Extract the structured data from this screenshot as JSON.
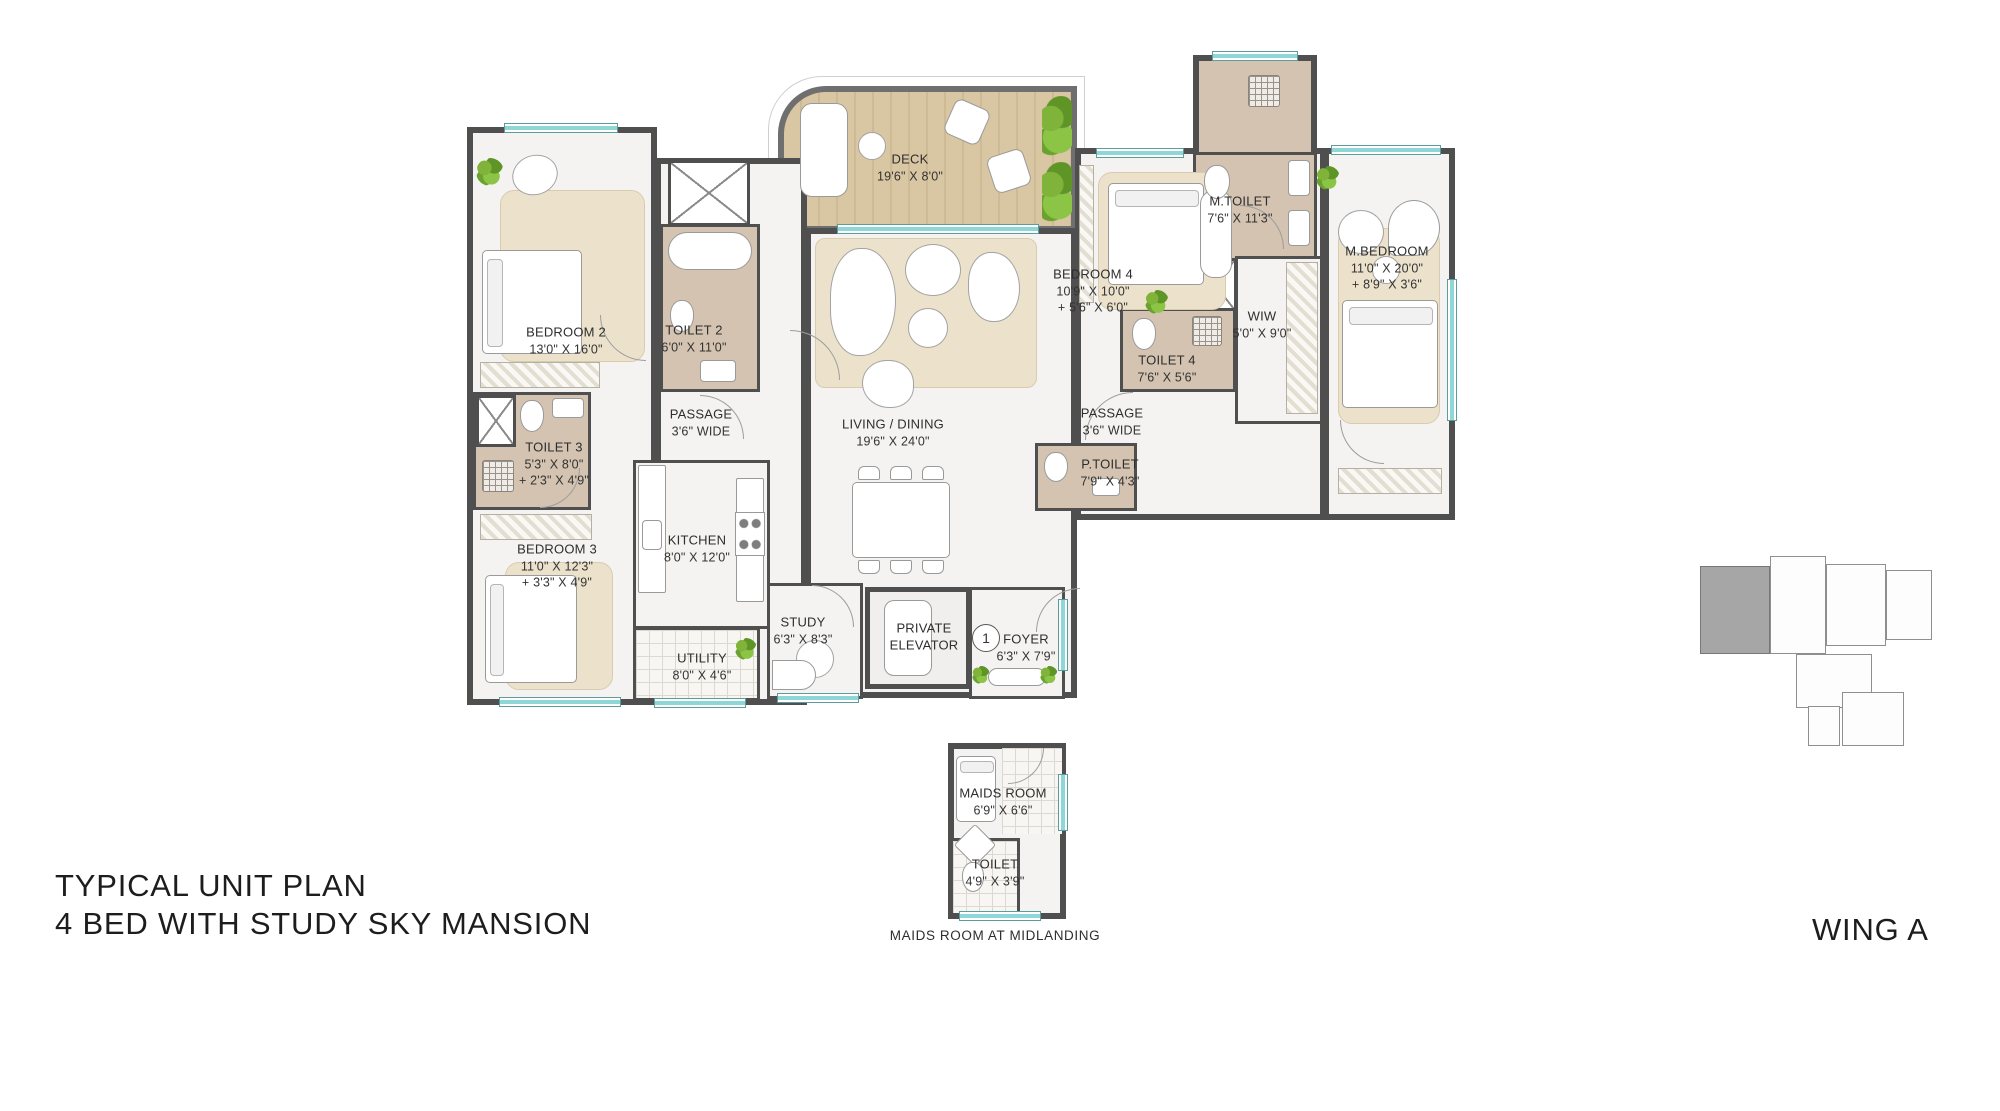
{
  "title": {
    "line1": "TYPICAL UNIT PLAN",
    "line2": "4 BED WITH STUDY SKY MANSION"
  },
  "wing": "WING A",
  "footnote": "MAIDS ROOM AT MIDLANDING",
  "foyer_marker": "1",
  "rooms": {
    "deck": {
      "name": "DECK",
      "dims": "19'6\" X 8'0\""
    },
    "bedroom2": {
      "name": "BEDROOM 2",
      "dims": "13'0\" X 16'0\""
    },
    "toilet2": {
      "name": "TOILET 2",
      "dims": "6'0\" X 11'0\""
    },
    "passage_left": {
      "name": "PASSAGE",
      "dims": "3'6\" WIDE"
    },
    "living": {
      "name": "LIVING / DINING",
      "dims": "19'6\" X 24'0\""
    },
    "bedroom4": {
      "name": "BEDROOM 4",
      "dims": "10'9\" X 10'0\"",
      "dims2": "+ 5'6\" X 6'0\""
    },
    "m_toilet": {
      "name": "M.TOILET",
      "dims": "7'6\" X 11'3\""
    },
    "wiw": {
      "name": "WIW",
      "dims": "5'0\" X 9'0\""
    },
    "toilet4": {
      "name": "TOILET 4",
      "dims": "7'6\" X 5'6\""
    },
    "passage_right": {
      "name": "PASSAGE",
      "dims": "3'6\" WIDE"
    },
    "m_bedroom": {
      "name": "M.BEDROOM",
      "dims": "11'0\" X 20'0\"",
      "dims2": "+ 8'9\" X 3'6\""
    },
    "toilet3": {
      "name": "TOILET 3",
      "dims": "5'3\" X 8'0\"",
      "dims2": "+ 2'3\" X 4'9\""
    },
    "p_toilet": {
      "name": "P.TOILET",
      "dims": "7'9\" X 4'3\""
    },
    "bedroom3": {
      "name": "BEDROOM 3",
      "dims": "11'0\" X 12'3\"",
      "dims2": "+ 3'3\" X 4'9\""
    },
    "kitchen": {
      "name": "KITCHEN",
      "dims": "8'0\" X 12'0\""
    },
    "utility": {
      "name": "UTILITY",
      "dims": "8'0\" X 4'6\""
    },
    "study": {
      "name": "STUDY",
      "dims": "6'3\" X 8'3\""
    },
    "private_elevator": {
      "name": "PRIVATE ELEVATOR"
    },
    "foyer": {
      "name": "FOYER",
      "dims": "6'3\" X 7'9\""
    },
    "maids_room": {
      "name": "MAIDS ROOM",
      "dims": "6'9\" X 6'6\""
    },
    "maids_toilet": {
      "name": "TOILET",
      "dims": "4'9\" X 3'9\""
    }
  },
  "colors": {
    "wall": "#4f4f4f",
    "wet_floor": "#d3c3b0",
    "deck_wood": "#d9c6a2",
    "window": "#8fd6d6",
    "keyplan_highlight": "#a6a6a6"
  }
}
